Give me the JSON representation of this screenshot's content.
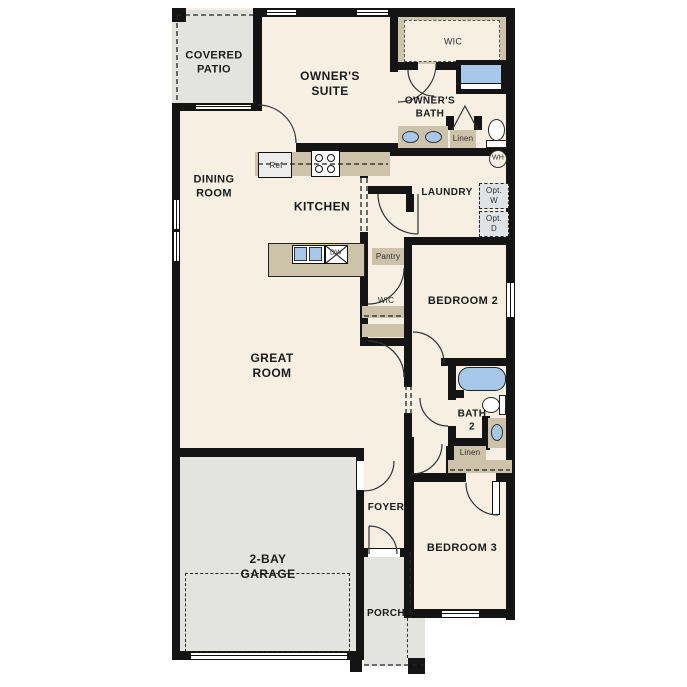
{
  "rooms": {
    "covered_patio": "COVERED\nPATIO",
    "owners_suite": "OWNER'S\nSUITE",
    "wic_owner": "WIC",
    "owners_bath": "OWNER'S\nBATH",
    "dining_room": "DINING\nROOM",
    "kitchen": "KITCHEN",
    "laundry": "LAUNDRY",
    "great_room": "GREAT\nROOM",
    "bedroom_2": "BEDROOM 2",
    "bath_2": "BATH\n2",
    "bedroom_3": "BEDROOM 3",
    "foyer": "FOYER",
    "porch": "PORCH",
    "garage": "2-BAY\nGARAGE"
  },
  "fixtures": {
    "refrigerator": "Ref",
    "dishwasher": "DW",
    "pantry": "Pantry",
    "wic_bedroom2": "WIC",
    "linen_owner": "Linen",
    "linen_hall": "Linen",
    "water_heater": "WH",
    "opt_washer": "Opt.\nW",
    "opt_dryer": "Opt.\nD"
  },
  "colors": {
    "floor": "#f6efe2",
    "outdoor": "#e3e3e0",
    "cabinet": "#cdc2aa",
    "fixture_blue": "#a8c8e9",
    "appliance": "#ededed",
    "optional_appliance": "#dfe3e6",
    "wall": "#141414"
  }
}
